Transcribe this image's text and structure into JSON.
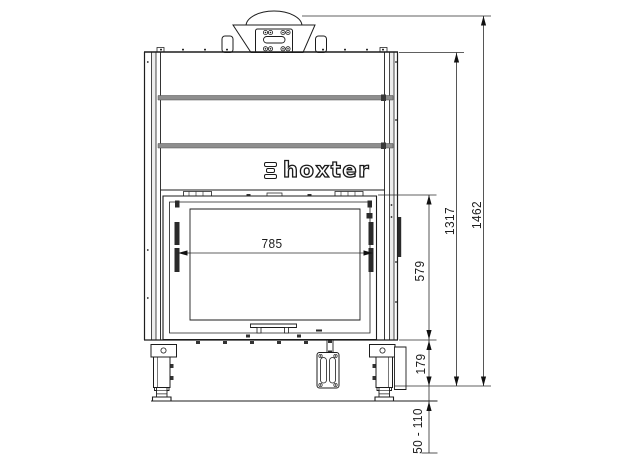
{
  "drawing": {
    "brand": "hoxter",
    "dimensions": {
      "door_width": "785",
      "door_opening_height": "579",
      "firebox_height": "1317",
      "total_height": "1462",
      "base_height": "179",
      "feet_adjust_range": "50 - 110"
    }
  }
}
